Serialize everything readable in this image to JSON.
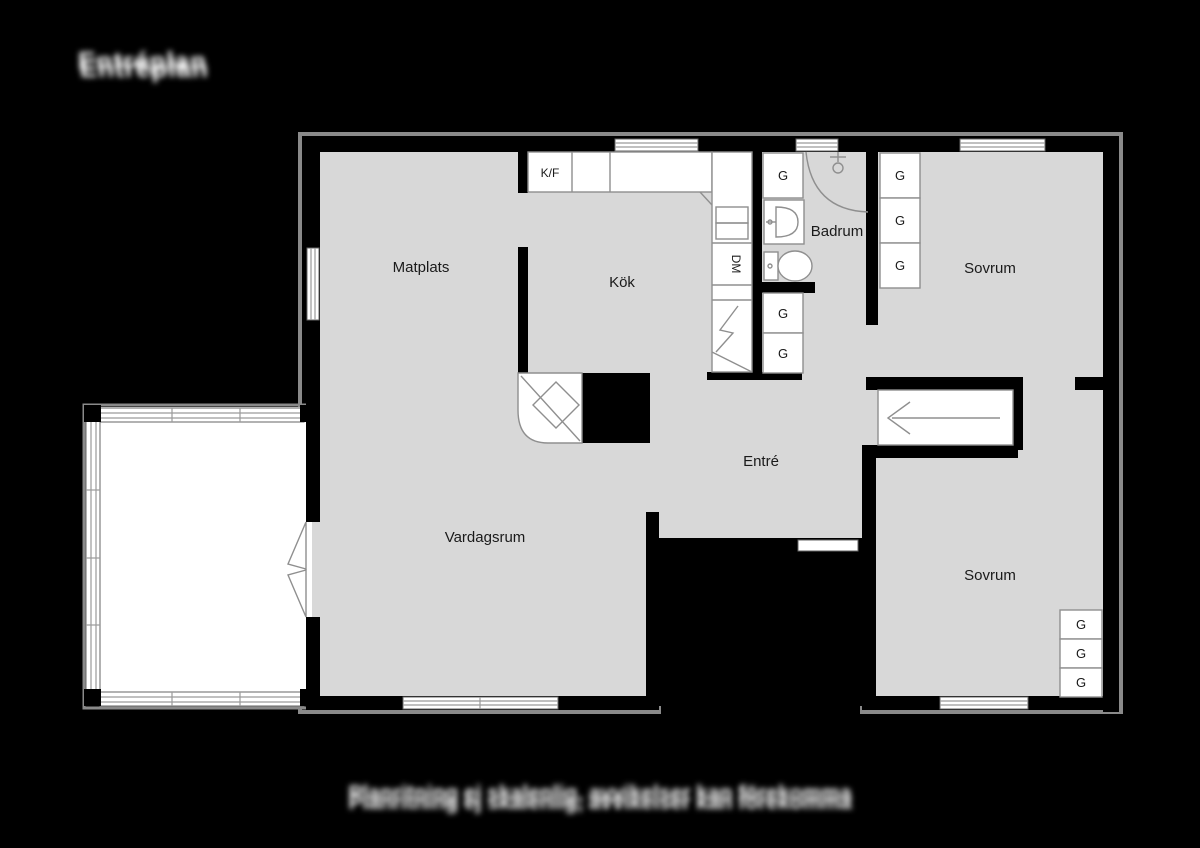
{
  "header": {
    "title": "Entréplan"
  },
  "footer": {
    "caption": "Planritning ej skalenlig, avvikelser kan förekomma"
  },
  "plan": {
    "rooms": {
      "matplats": "Matplats",
      "kok": "Kök",
      "badrum": "Badrum",
      "sovrum_top": "Sovrum",
      "entre": "Entré",
      "vardagsrum": "Vardagsrum",
      "sovrum_bottom": "Sovrum"
    },
    "appliances": {
      "fridge_freezer": "K/F",
      "dishwasher": "DM"
    },
    "closet_label": "G",
    "colors": {
      "background": "#000000",
      "floor": "#d8d8d8",
      "wall": "#000000",
      "contour": "#8a8a8a",
      "fixture_stroke": "#8f8f8f",
      "label": "#1a1a1a",
      "paper": "#ffffff"
    }
  }
}
